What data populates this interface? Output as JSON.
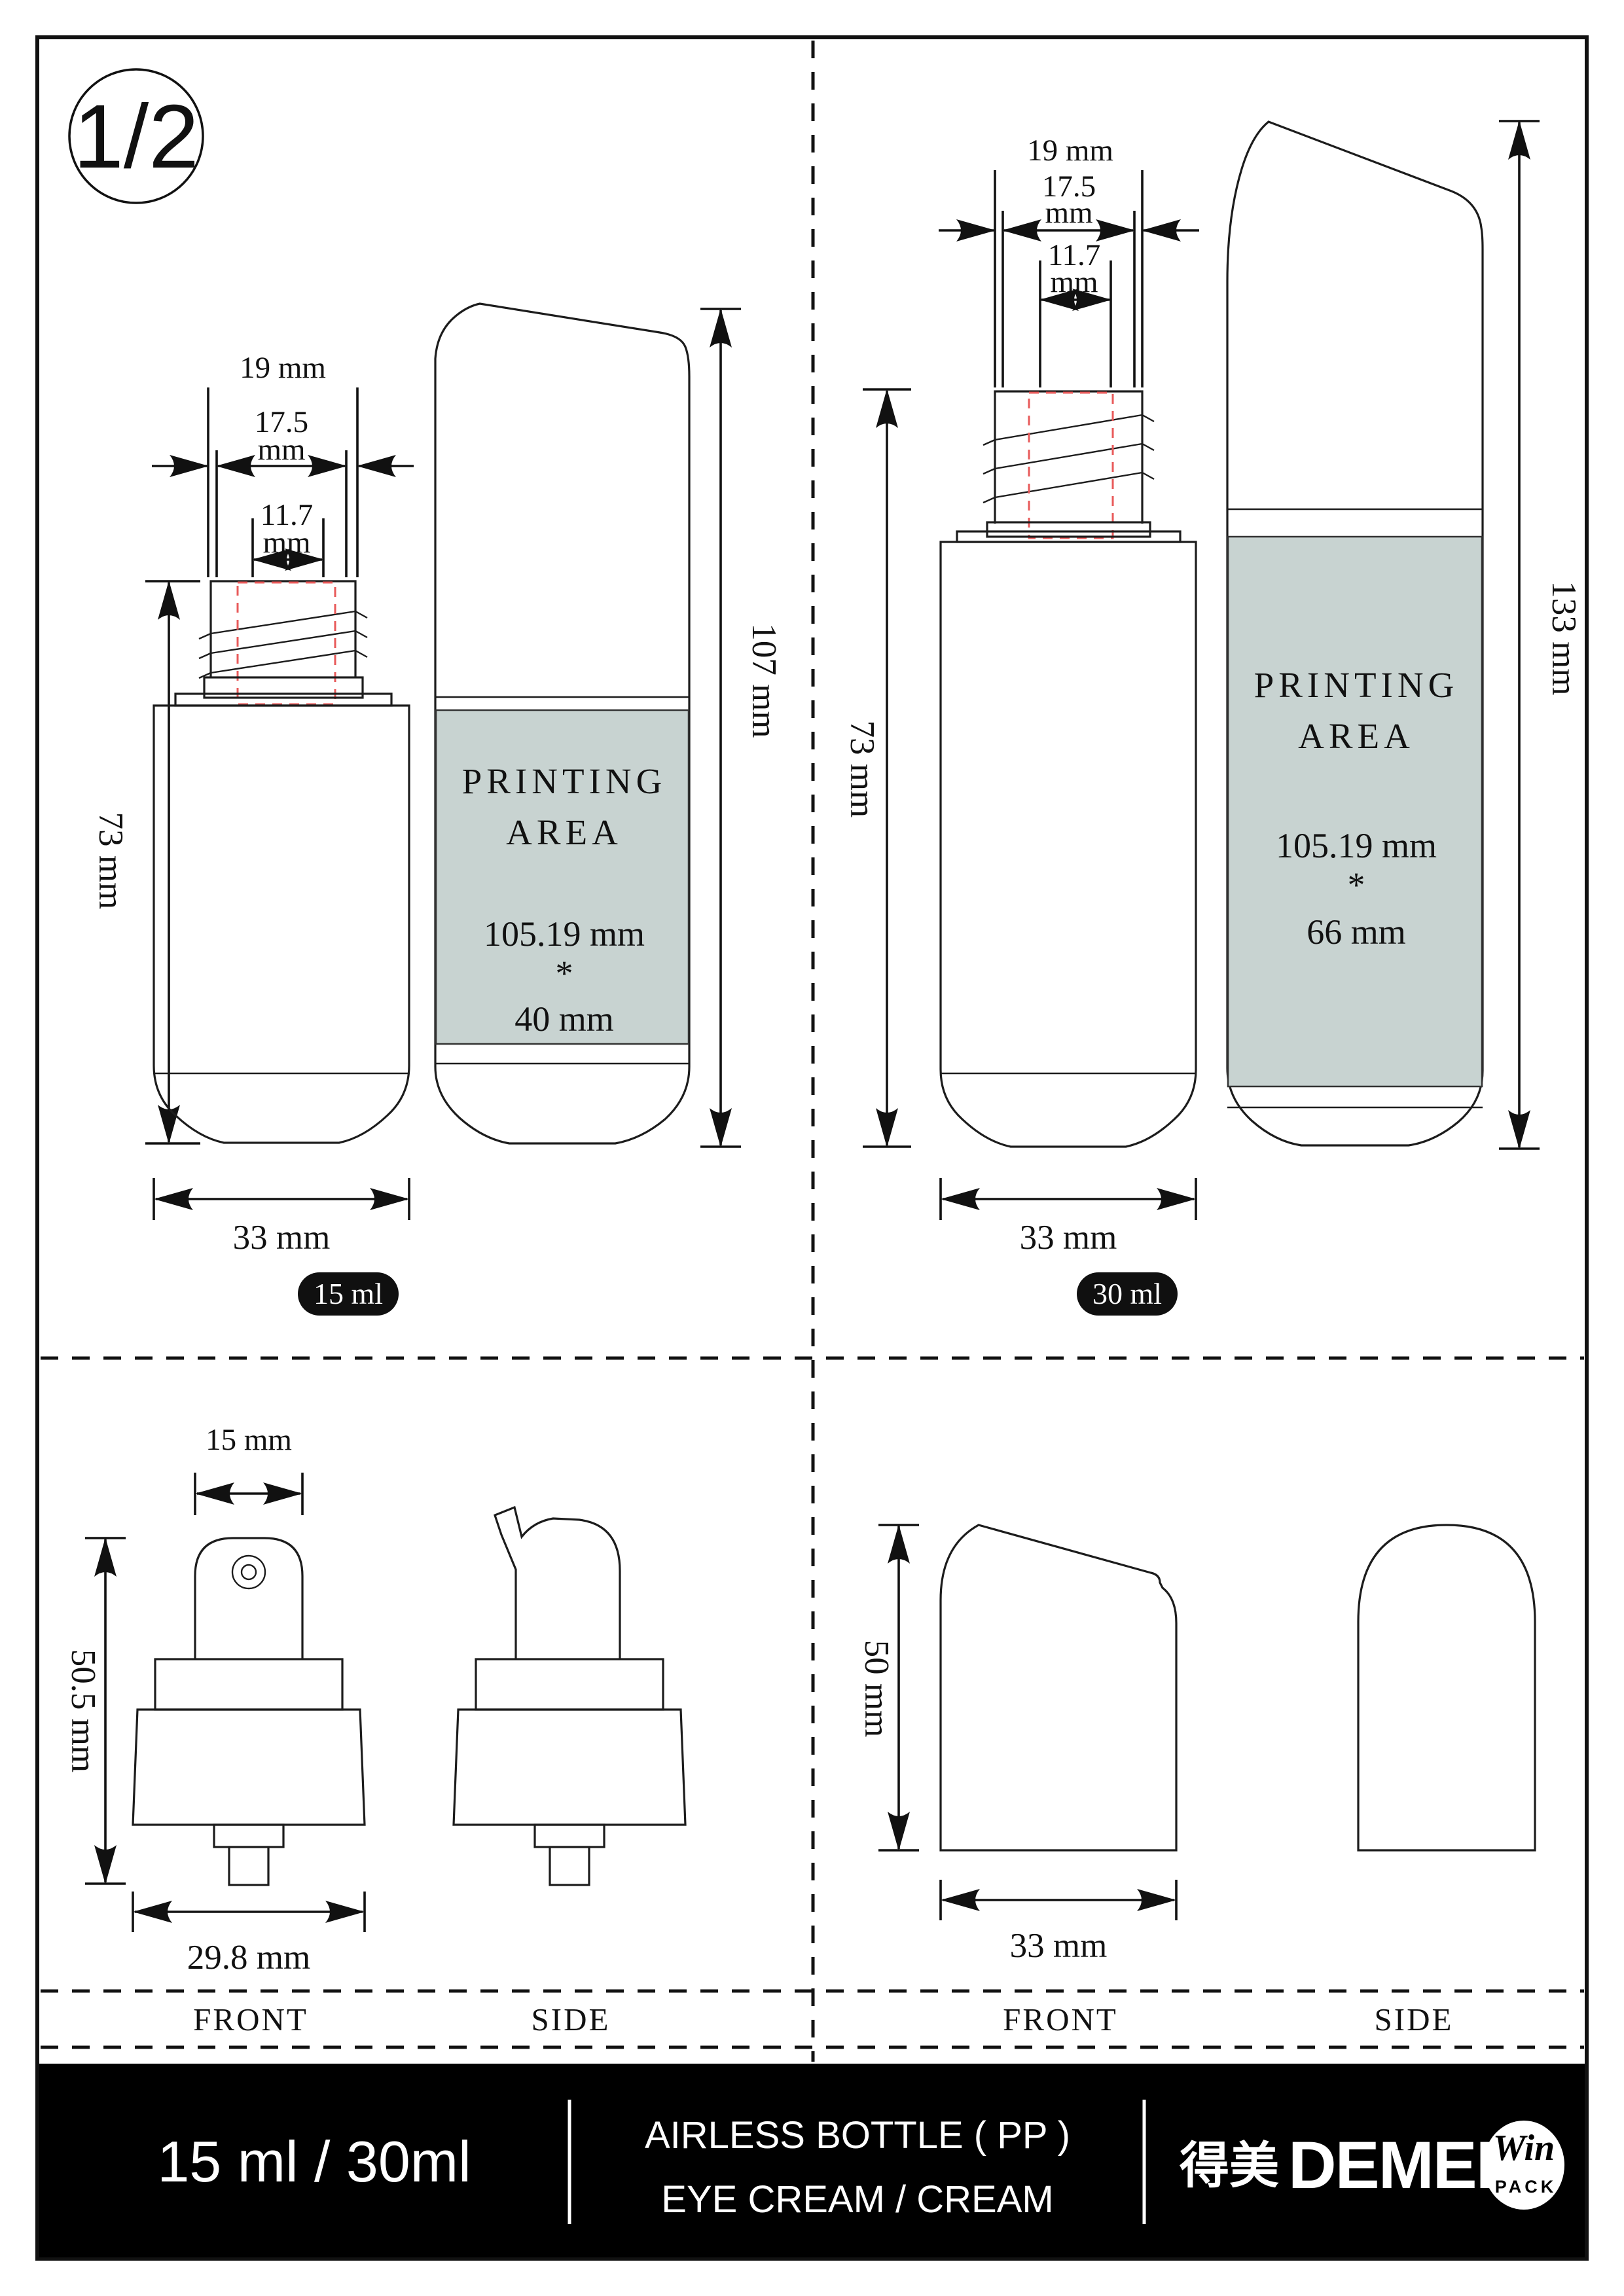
{
  "page": {
    "number": "1/2"
  },
  "colors": {
    "printing_area_fill": "#c8d3d1",
    "red_dash": "#e85a5a",
    "badge_bg": "#101010",
    "footer_bg": "#000000"
  },
  "bottle_15": {
    "dim_neck_outer": "19 mm",
    "dim_neck_mid_l1": "17.5",
    "dim_neck_mid_l2": "mm",
    "dim_neck_inner_l1": "11.7",
    "dim_neck_inner_l2": "mm",
    "dim_body_height": "73 mm",
    "dim_width": "33 mm",
    "dim_total_height": "107 mm",
    "printing_l1": "PRINTING",
    "printing_l2": "AREA",
    "printing_w": "105.19 mm",
    "printing_sep": "*",
    "printing_h": "40 mm",
    "badge": "15 ml"
  },
  "bottle_30": {
    "dim_neck_outer": "19 mm",
    "dim_neck_mid_l1": "17.5",
    "dim_neck_mid_l2": "mm",
    "dim_neck_inner_l1": "11.7",
    "dim_neck_inner_l2": "mm",
    "dim_body_height": "73 mm",
    "dim_width": "33 mm",
    "dim_total_height": "133 mm",
    "printing_l1": "PRINTING",
    "printing_l2": "AREA",
    "printing_w": "105.19 mm",
    "printing_sep": "*",
    "printing_h": "66 mm",
    "badge": "30 ml"
  },
  "pump": {
    "dim_top_width": "15 mm",
    "dim_height": "50.5 mm",
    "dim_base_width": "29.8 mm",
    "label_front": "FRONT",
    "label_side": "SIDE"
  },
  "cap": {
    "dim_height": "50 mm",
    "dim_width": "33 mm",
    "label_front": "FRONT",
    "label_side": "SIDE"
  },
  "footer": {
    "volumes": "15 ml / 30ml",
    "product_l1": "AIRLESS BOTTLE ( PP )",
    "product_l2": "EYE CREAM / CREAM",
    "brand_cn": "得美",
    "brand_en": "DEMEI",
    "logo_script": "Win",
    "logo_sub": "PACK"
  }
}
